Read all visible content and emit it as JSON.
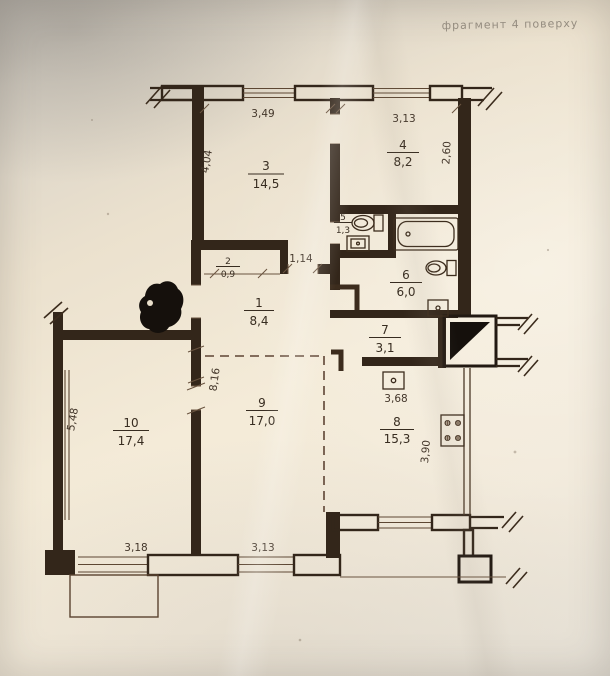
{
  "page": {
    "title": "фрагмент 4 поверху"
  },
  "plan": {
    "rooms": [
      {
        "number": "1",
        "area": "8,4"
      },
      {
        "number": "2",
        "area": "0,9"
      },
      {
        "number": "3",
        "area": "14,5"
      },
      {
        "number": "4",
        "area": "8,2"
      },
      {
        "number": "5",
        "area": "1,3"
      },
      {
        "number": "6",
        "area": "6,0"
      },
      {
        "number": "7",
        "area": "3,1"
      },
      {
        "number": "8",
        "area": "15,3"
      },
      {
        "number": "9",
        "area": "17,0"
      },
      {
        "number": "10",
        "area": "17,4"
      }
    ],
    "dimensions": {
      "top_room3": "3,49",
      "left_room3": "4,04",
      "top_room4": "3,13",
      "right_room4": "2,60",
      "hall_opening": "1,14",
      "kitchen_top": "3,68",
      "kitchen_right": "3,90",
      "wall_9_10": "8,16",
      "left_room10": "5,48",
      "bottom_room10": "3,18",
      "bottom_room9": "3,13"
    }
  },
  "colors": {
    "ink": "#33261a",
    "paper": "#f2e9d7",
    "dash": "#5e4434"
  }
}
